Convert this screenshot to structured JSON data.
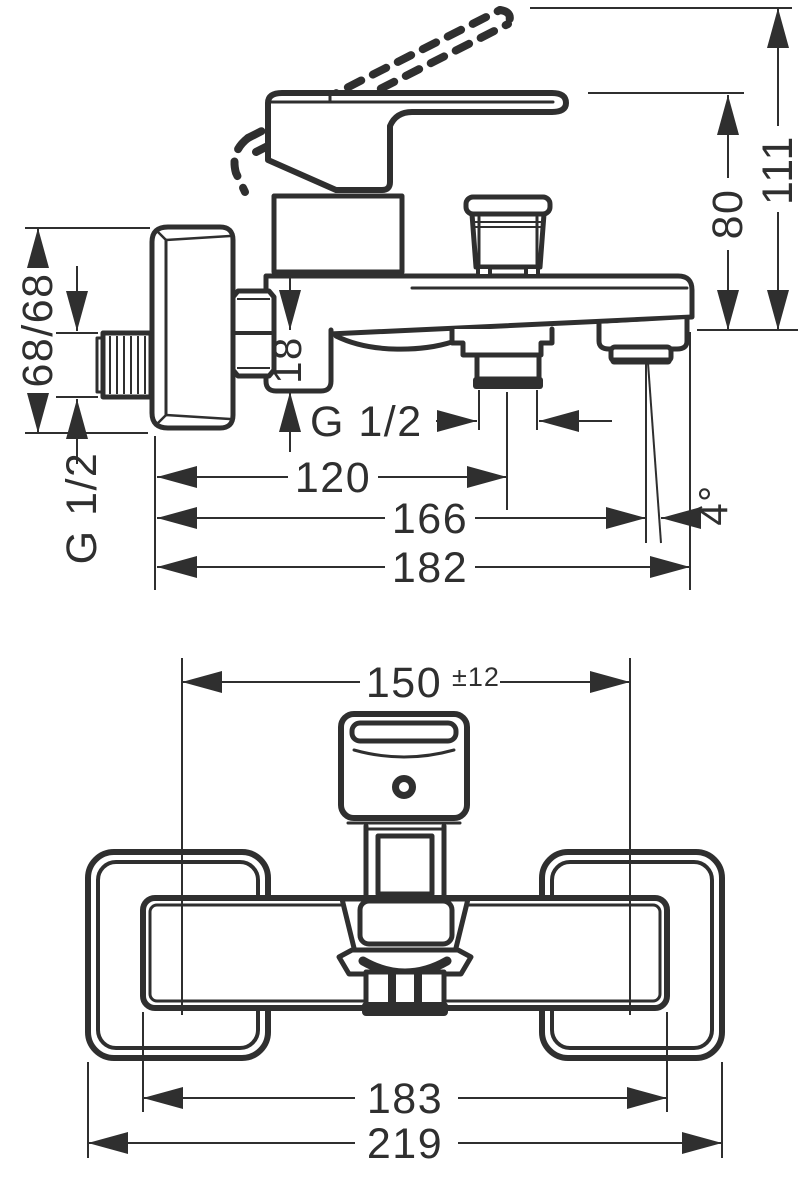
{
  "colors": {
    "background": "#ffffff",
    "line": "#2f2f2f"
  },
  "side_view": {
    "dim_height_total": "111",
    "dim_height_handle": "80",
    "dim_wall_offsets": "68/68",
    "dim_connection_height": "18",
    "thread_wall_connection": "G 1/2",
    "thread_shower_outlet": "G 1/2",
    "dim_depth_shower_outlet": "120",
    "dim_depth_spout": "166",
    "dim_depth_total": "182",
    "spout_angle": "4°"
  },
  "front_view": {
    "dim_connection_centers": "150",
    "dim_connection_tolerance": "±12",
    "dim_body_width": "183",
    "dim_total_width": "219"
  }
}
